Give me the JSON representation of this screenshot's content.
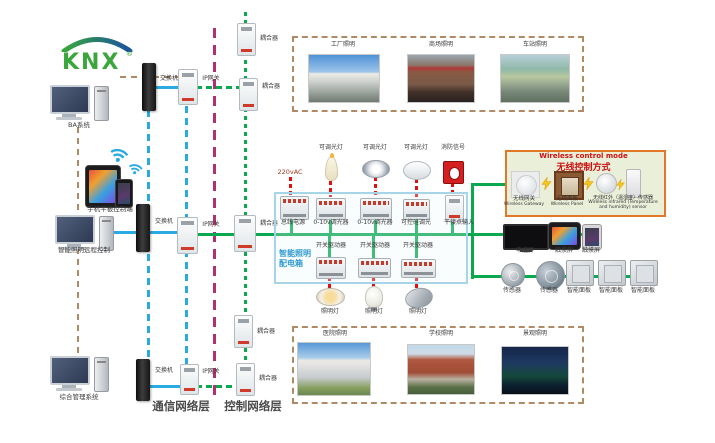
{
  "logo": {
    "text": "KNX",
    "reg": "®"
  },
  "left": {
    "pc_ba": "BA系统",
    "mobile": "手机平板控制端",
    "pc_lighting": "智能照明远程控制",
    "pc_mgmt": "综合管理系统"
  },
  "network": {
    "row_top": {
      "switch": "交换机",
      "gateway": "IP网关"
    },
    "row_mid": {
      "switch": "交换机",
      "gateway": "IP网关"
    },
    "row_bottom": {
      "switch": "交换机",
      "gateway": "IP网关"
    },
    "couplers": [
      "耦合器",
      "耦合器",
      "耦合器",
      "耦合器",
      "耦合器"
    ],
    "layer_comm": "通信网络层",
    "layer_ctrl": "控制网络层"
  },
  "scenes_top": [
    "工厂照明",
    "商场照明",
    "车站照明"
  ],
  "scenes_bottom": [
    "医院照明",
    "学校照明",
    "景观照明"
  ],
  "cabinet": {
    "title1": "智能照明",
    "title2": "配电箱",
    "power": "220vAC",
    "loads_top": [
      "可调光灯",
      "可调光灯",
      "可调光灯",
      "消防信号"
    ],
    "modules_top": [
      "总线电源",
      "0-10v调光器",
      "0-10v调光器",
      "可控硅调光",
      "干接点输入"
    ],
    "modules_bottom": [
      "开关驱动器",
      "开关驱动器",
      "开关驱动器"
    ],
    "loads_bottom": [
      "照明灯",
      "照明灯",
      "照明灯"
    ]
  },
  "wireless": {
    "title_en": "Wireless control mode",
    "title_zh": "无线控制方式",
    "items": [
      {
        "zh": "无线网关",
        "en": "Wireless Gateway"
      },
      {
        "zh": "无线面板",
        "en": "Wireless Panel"
      },
      {
        "zh": "无线红外（温湿度）传感器",
        "en": "Wireless infrared (Temperature and humidity) sensor"
      }
    ]
  },
  "right": {
    "screens": [
      "中控屏",
      "触摸屏",
      "触摸屏"
    ],
    "devices": [
      "传感器",
      "传感器",
      "智能面板",
      "智能面板",
      "智能面板"
    ]
  },
  "colors": {
    "bus_green": "#0aa84f",
    "ethernet_blue": "#29abe2",
    "layer_divider": "#b03070",
    "scene_dash": "#b08a64",
    "power_red": "#e01010",
    "cabinet_border": "#a8d4e8",
    "wireless_border": "#e07828",
    "wireless_bg": "#e9efd8",
    "title_red": "#cc1111",
    "knx_green": "#3aa63c"
  }
}
